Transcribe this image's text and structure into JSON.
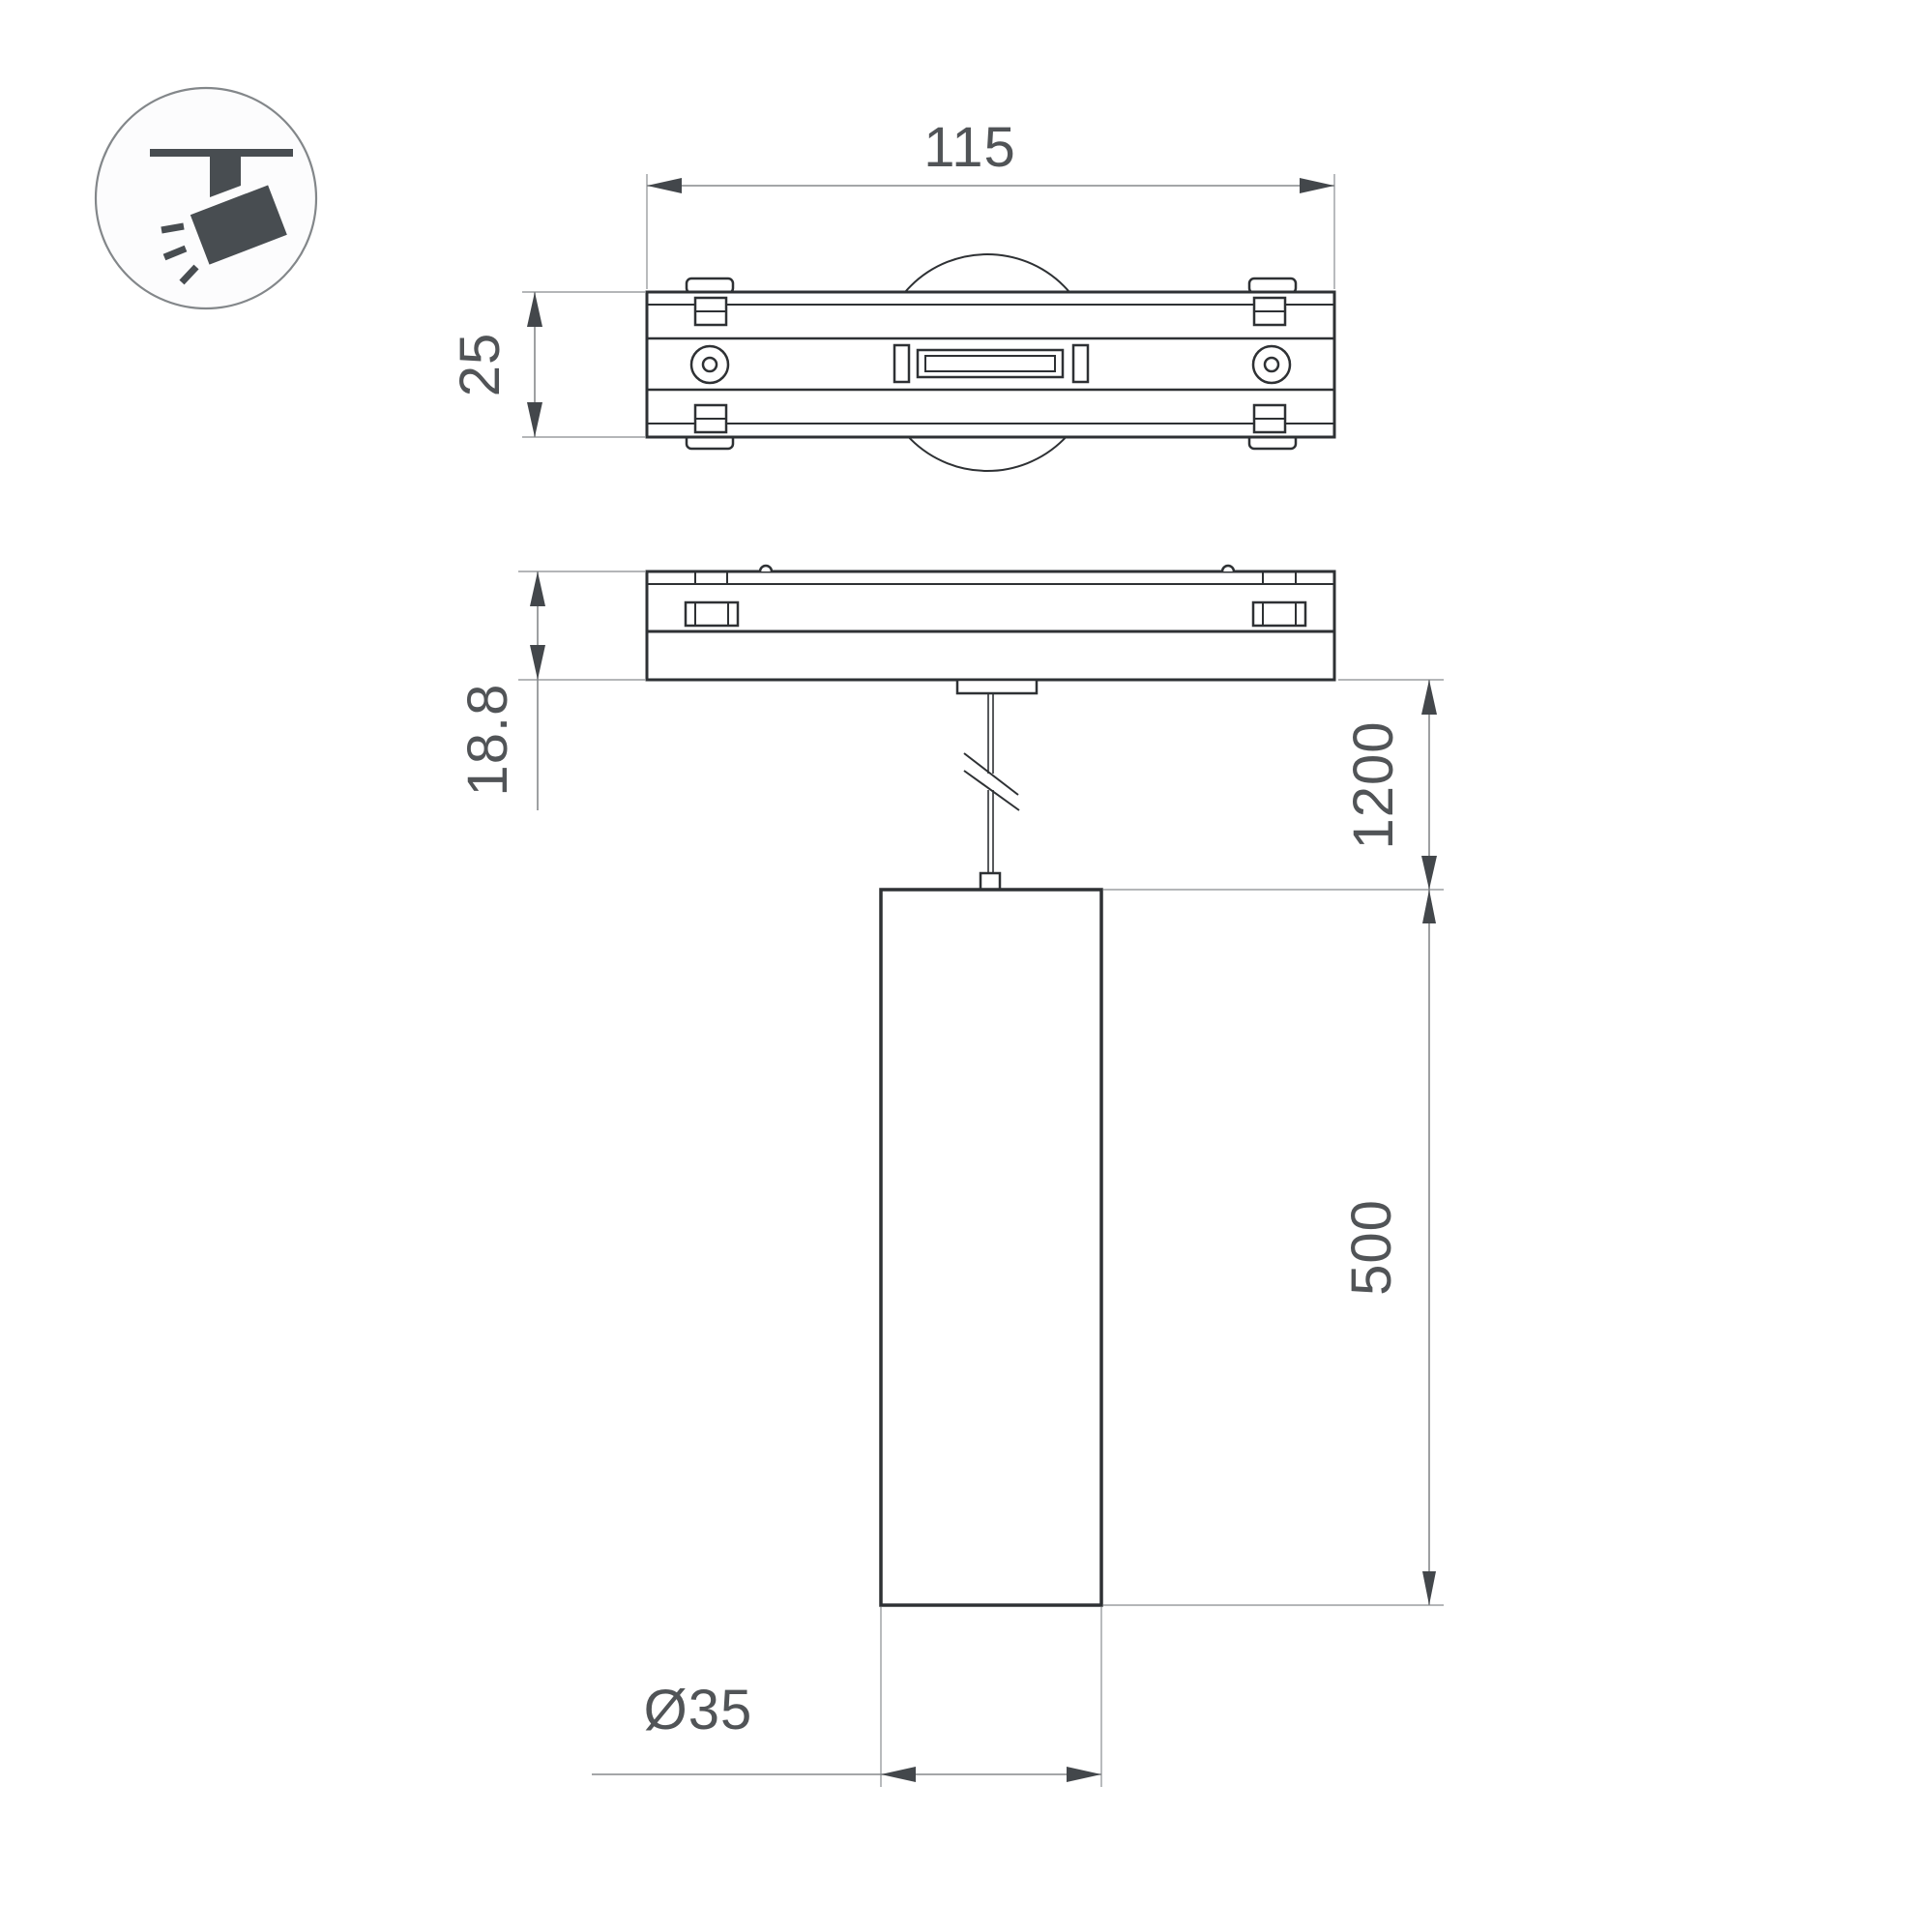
{
  "drawing": {
    "title": "track pendant luminaire dimension drawing",
    "views": [
      "top-view",
      "side-view",
      "pendant-front-view"
    ],
    "icon": "track-spotlight-icon"
  },
  "dimensions": {
    "track_length": "115",
    "track_width": "25",
    "adapter_height": "18.8",
    "suspension_length": "1200",
    "body_height": "500",
    "body_diameter": "Ø35"
  },
  "colors": {
    "background": "#ffffff",
    "outline": "#2e3134",
    "dimension_line": "#85888b",
    "extension_line": "#9b9ea1",
    "arrow": "#43474b",
    "text": "#515457",
    "icon_fill": "#484d51",
    "icon_ring": "#83878a"
  }
}
